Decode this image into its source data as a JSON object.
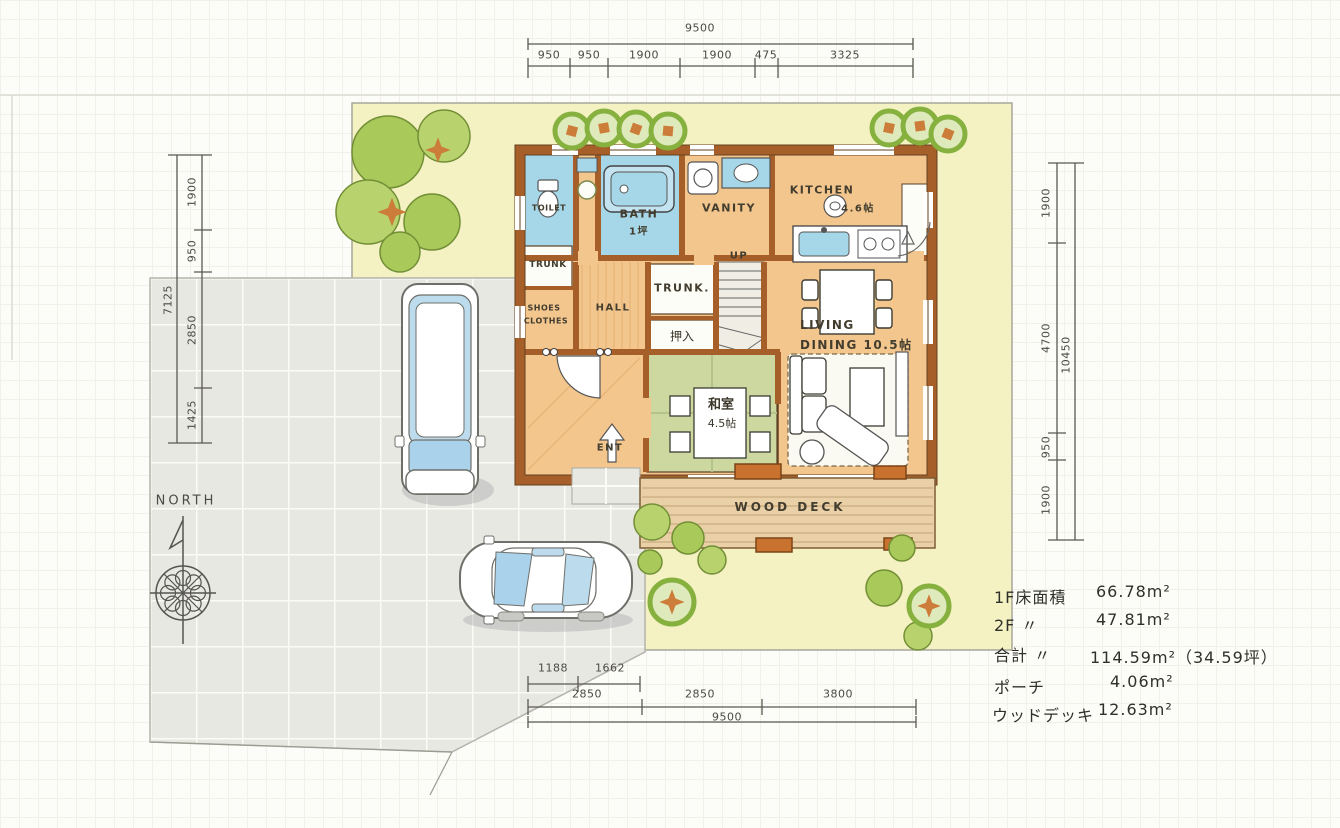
{
  "dimensions": {
    "top": {
      "overall": "9500",
      "segments": [
        "950",
        "950",
        "1900",
        "1900",
        "475",
        "3325"
      ]
    },
    "left": {
      "overall": "7125",
      "segments": [
        "1900",
        "950",
        "2850",
        "1425"
      ]
    },
    "right": {
      "overall": "10450",
      "segments": [
        "1900",
        "4700",
        "950",
        "1900"
      ]
    },
    "bottom": {
      "overall": "9500",
      "segments": [
        "2850",
        "2850",
        "3800"
      ],
      "sub_segments": [
        "1188",
        "1662"
      ]
    }
  },
  "compass": {
    "label": "NORTH"
  },
  "rooms": {
    "toilet": "TOILET",
    "bath": "BATH",
    "bath_size": "1坪",
    "vanity": "VANITY",
    "kitchen": "KITCHEN",
    "kitchen_size": "4.6帖",
    "trunk_a": "TRUNK",
    "shoes": "SHOES",
    "clothes": "CLOTHES",
    "hall": "HALL",
    "trunk_b": "TRUNK.",
    "oshiire": "押入",
    "up": "UP",
    "washitsu": "和室",
    "washitsu_size": "4.5帖",
    "living": "LIVING",
    "dining": "DINING 10.5帖",
    "entrance": "ENT",
    "wood_deck": "WOOD DECK"
  },
  "area_table": {
    "rows": [
      {
        "label": "1F床面積",
        "value": "66.78m²"
      },
      {
        "label": "2F 〃",
        "value": "47.81m²"
      },
      {
        "label": "合計 〃",
        "value": "114.59m²（34.59坪）"
      },
      {
        "label": "ポーチ",
        "value": "4.06m²"
      },
      {
        "label": "ウッドデッキ",
        "value": "12.63m²"
      }
    ]
  },
  "colors": {
    "site_yellow": "#f4f2c2",
    "floor_tan": "#f3c68e",
    "wall_orange": "#a65f28",
    "water_blue": "#a6d7e8",
    "tatami_green": "#ccd8a0",
    "deck_tan": "#ead0a6",
    "tree_green": "#a9c95b",
    "accent_orange": "#cd7d3a",
    "pavement_grey": "#e8e8e3",
    "pencil": "#55554e"
  }
}
